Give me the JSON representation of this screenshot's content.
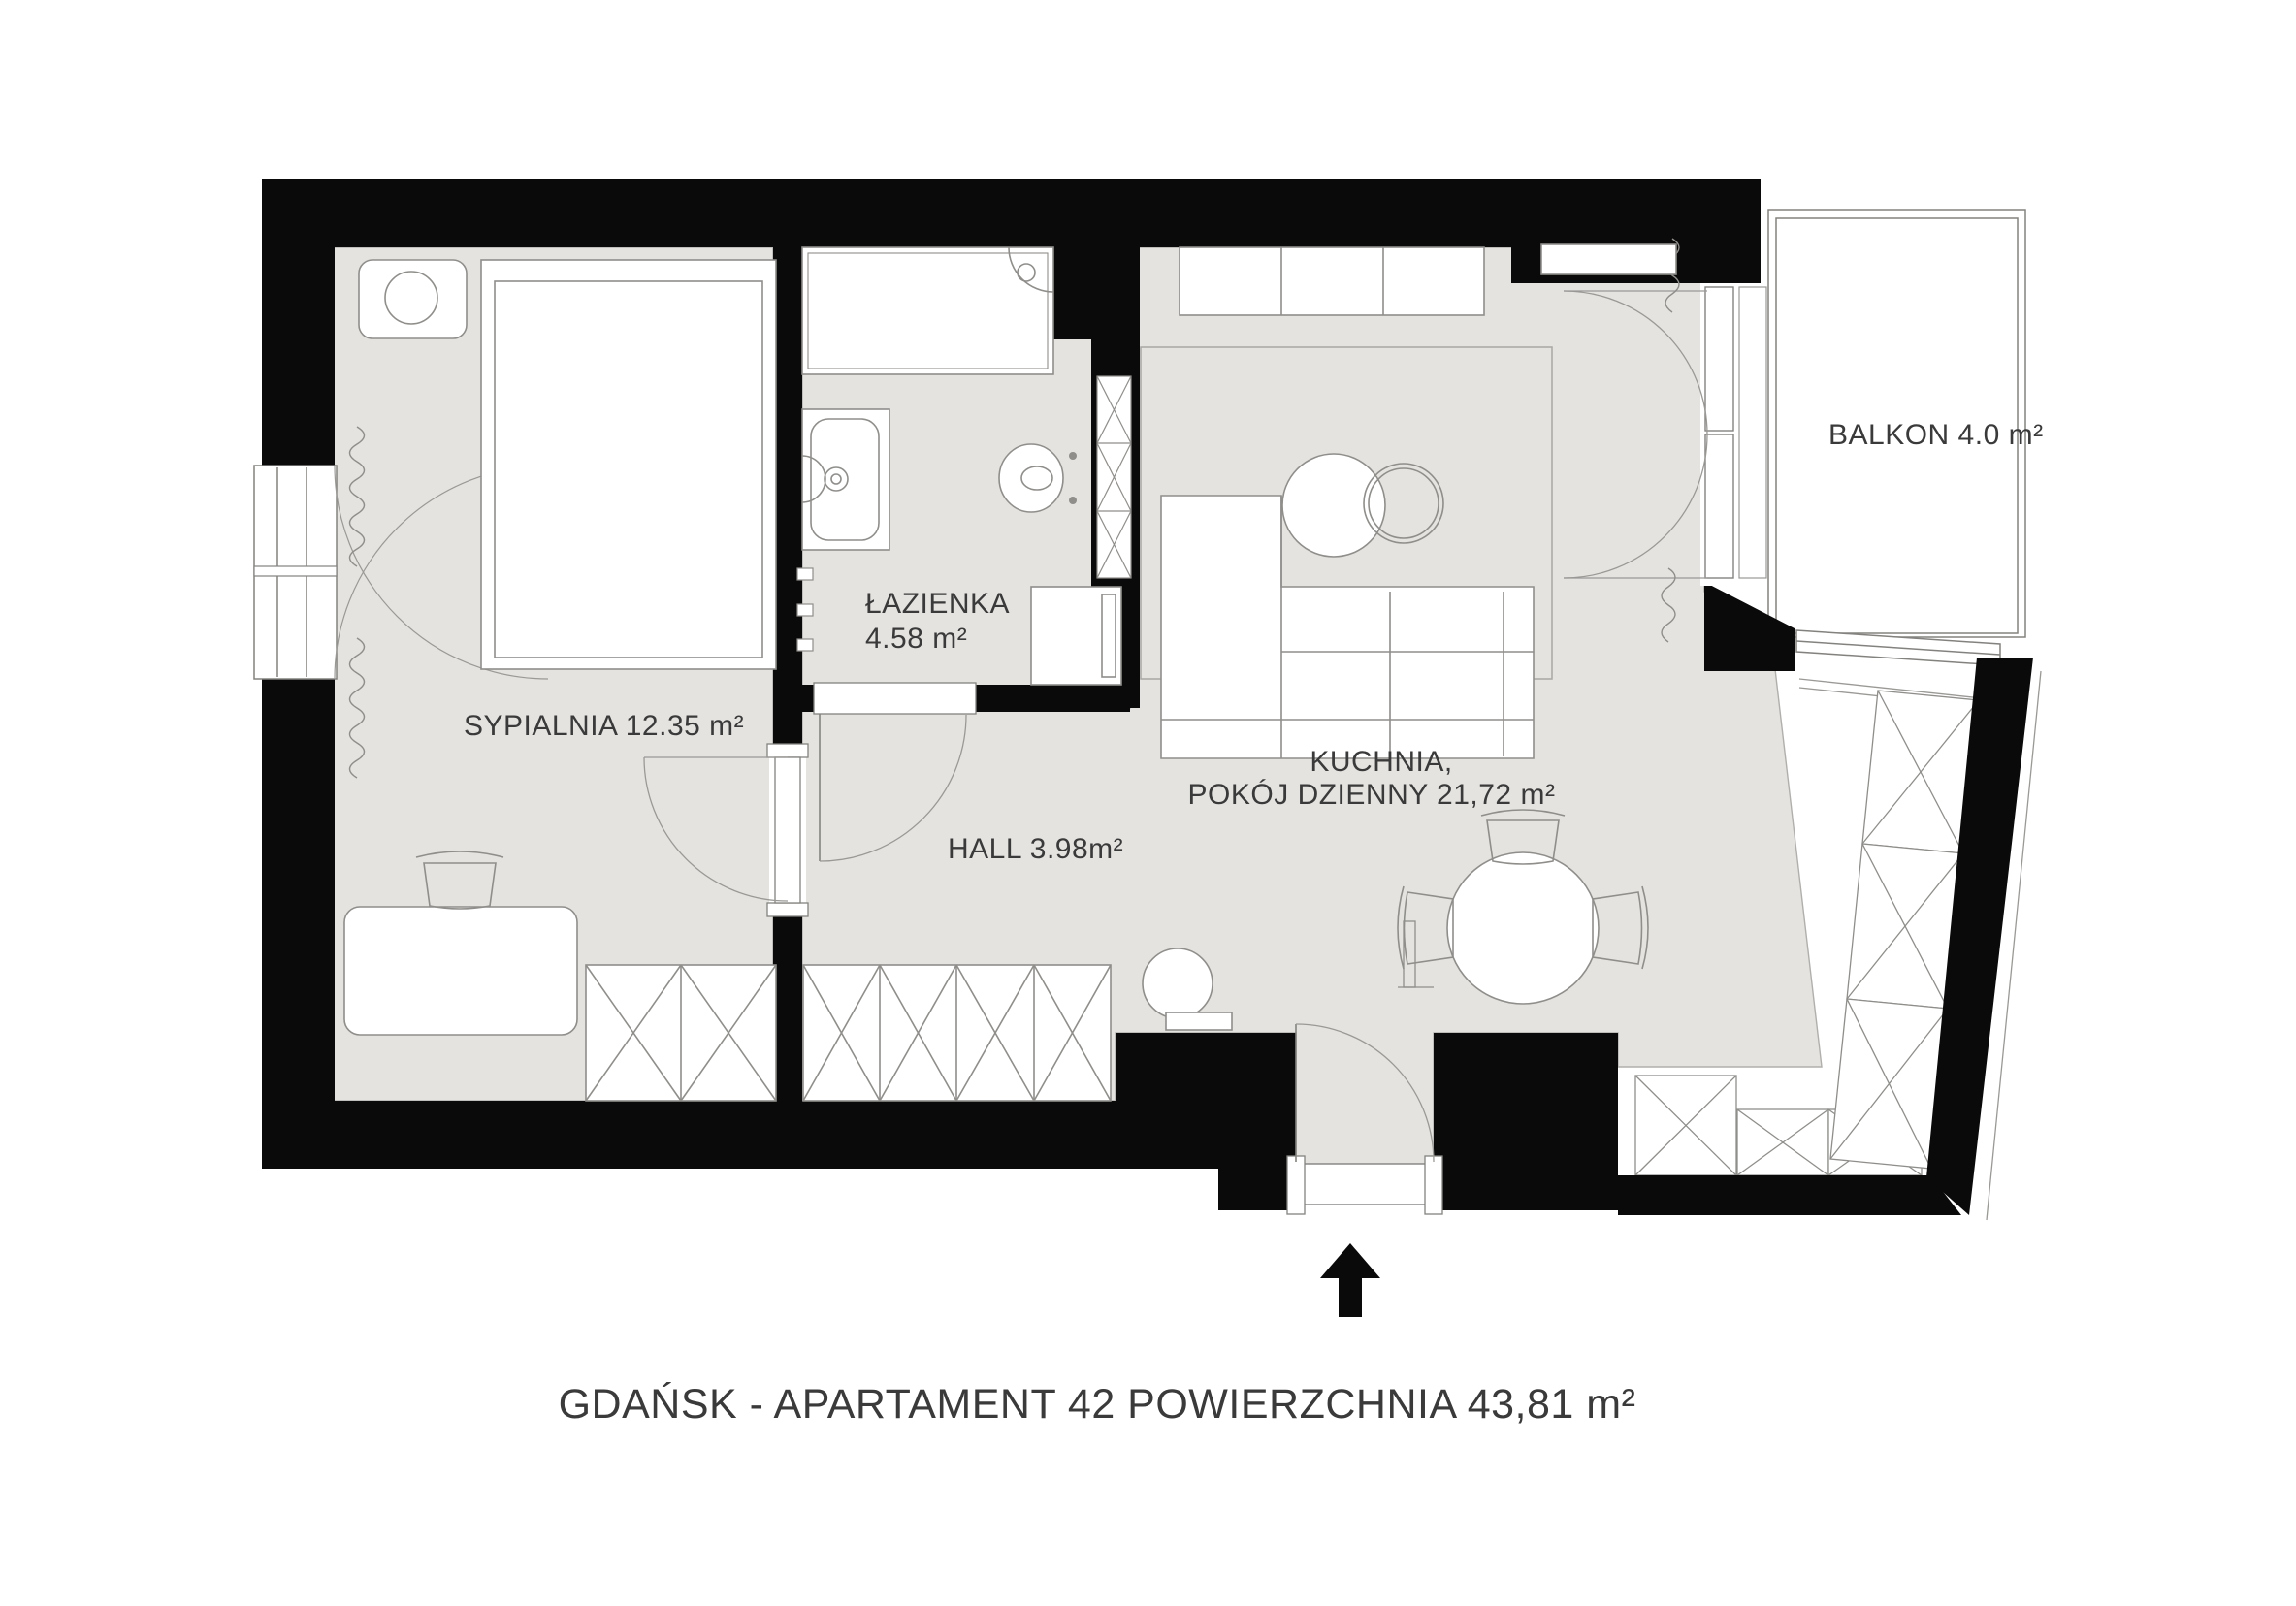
{
  "title": {
    "text": "GDAŃSK - APARTAMENT 42 POWIERZCHNIA 43,81 m²"
  },
  "rooms": {
    "bedroom": {
      "label": "SYPIALNIA 12.35 m²"
    },
    "bathroom": {
      "name": "ŁAZIENKA",
      "area": "4.58 m²"
    },
    "hall": {
      "label": "HALL 3.98m²"
    },
    "kitchen_living": {
      "name": "KUCHNIA,",
      "area_line": "POKÓJ DZIENNY 21,72 m²"
    },
    "balcony": {
      "label": "BALKON 4.0 m²"
    }
  },
  "icons": {
    "entrance_arrow": "entrance-direction-arrow"
  },
  "colors": {
    "wall": "#0a0a0a",
    "floor": "#e4e3e0",
    "furniture_outline": "#8f8e8b",
    "floor_edge": "#b0afac",
    "background": "#ffffff",
    "label_text": "#3a3a3a"
  }
}
